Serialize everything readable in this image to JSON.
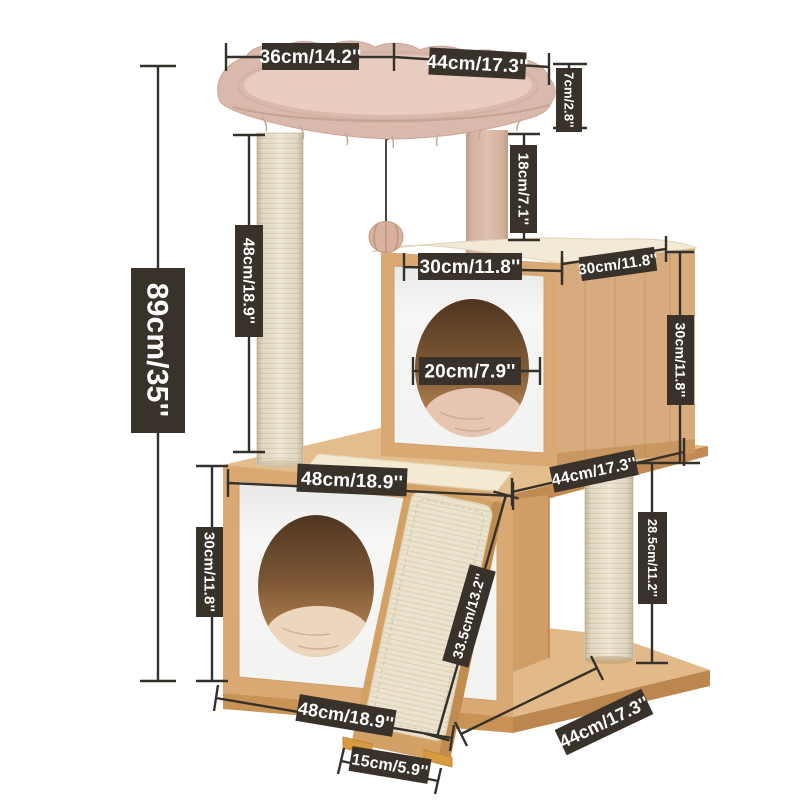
{
  "figure_title": "Cat tree dimension diagram",
  "dims": {
    "bed_top_width": "36cm/14.2''",
    "bed_top_depth": "44cm/17.3''",
    "bed_rim_height": "7cm/2.8''",
    "upper_post_height": "18cm/7.1''",
    "left_post_height": "48cm/18.9''",
    "total_height": "89cm/35''",
    "mid_box_width": "30cm/11.8''",
    "mid_box_depth": "30cm/11.8''",
    "mid_box_hole": "20cm/7.9''",
    "mid_box_height": "30cm/11.8''",
    "mid_level_depth": "44cm/17.3''",
    "mid_level_width": "48cm/18.9''",
    "lower_box_height": "30cm/11.8''",
    "lower_post_height": "28.5cm/11.2''",
    "ramp_length": "33.5cm/13.2''",
    "base_width": "48cm/18.9''",
    "base_depth": "44cm/17.3''",
    "ramp_stand_width": "15cm/5.9''"
  },
  "colors": {
    "background": "#ffffff",
    "label_bg": "#39322a",
    "label_text": "#ffffff",
    "dim_line": "#34302a",
    "wood_top": "#e4bd8d",
    "wood_front": "#d9a873",
    "wood_side": "#d8ab7e",
    "wood_edge_dark": "#c89157",
    "panel_white": "#f5f6f4",
    "sisal_cream": "#eee7d4",
    "bed_pink": "#d9b9ac",
    "bed_pink_light": "#e7ccbf",
    "cushion_cream": "#f2ead6",
    "ramp_foot_orange": "#d89a3e",
    "hole_interior_dark": "#4f3520"
  }
}
